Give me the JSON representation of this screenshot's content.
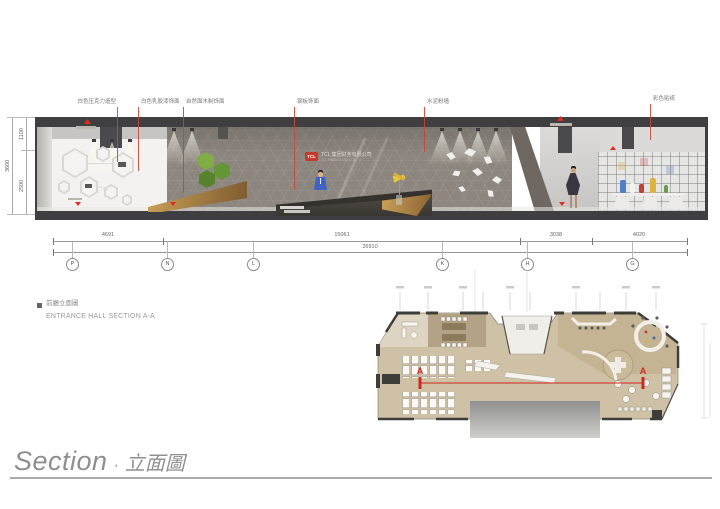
{
  "section": {
    "annotations": [
      "白色压克力造型",
      "白色乳胶漆饰面",
      "自然面木制饰面",
      "钢板饰面",
      "水泥粉墙",
      "彩色贴纸"
    ],
    "sign": {
      "logo": "TCL",
      "company_cn": "TCL 集团财务有限公司",
      "company_en": "TCL FINANCE CO.,LTD."
    },
    "dims_horizontal": {
      "segments": [
        "4691",
        "15061",
        "3038",
        "4020"
      ],
      "overall": "26910"
    },
    "dims_vertical": {
      "upper": "1100",
      "lower": "2500",
      "overall": "3600"
    },
    "grid_bubbles": [
      "P",
      "N",
      "L",
      "K",
      "H",
      "G"
    ]
  },
  "title_block": {
    "title_cn": "前廳立面圖",
    "title_en": "ENTRANCE HALL SECTION A-A"
  },
  "plan": {
    "section_marker": "A"
  },
  "footer": {
    "title_en": "Section",
    "separator": "·",
    "title_cn": "立面圖"
  },
  "colors": {
    "tcl_red": "#c23b2e",
    "marker_red": "#e02b1e",
    "section_line_red": "#d0281e",
    "wood": "#b98a4f",
    "moss_green": "#76a33c",
    "plan_floor": "#cfc1a5"
  }
}
